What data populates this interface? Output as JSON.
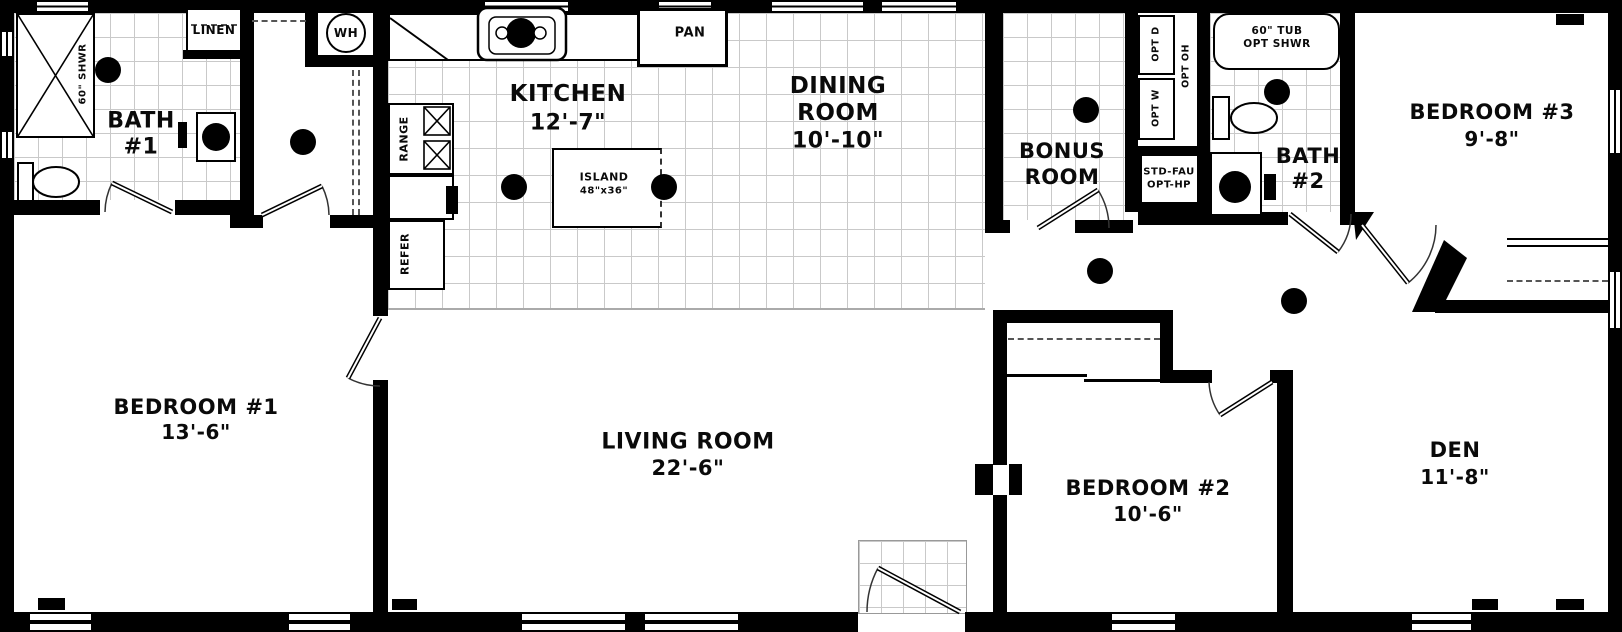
{
  "rooms": {
    "bath1": {
      "l1": "BATH",
      "l2": "#1"
    },
    "kitchen": {
      "l1": "KITCHEN",
      "dim": "12'-7\""
    },
    "dining": {
      "l1": "DINING",
      "l2": "ROOM",
      "dim": "10'-10\""
    },
    "bonus": {
      "l1": "BONUS",
      "l2": "ROOM"
    },
    "bath2": {
      "l1": "BATH",
      "l2": "#2"
    },
    "bedroom3": {
      "l1": "BEDROOM #3",
      "dim": "9'-8\""
    },
    "bedroom1": {
      "l1": "BEDROOM #1",
      "dim": "13'-6\""
    },
    "living": {
      "l1": "LIVING ROOM",
      "dim": "22'-6\""
    },
    "bedroom2": {
      "l1": "BEDROOM #2",
      "dim": "10'-6\""
    },
    "den": {
      "l1": "DEN",
      "dim": "11'-8\""
    }
  },
  "fixtures": {
    "linen": "LINEN",
    "water_heater": "WH",
    "pantry": "PAN",
    "range": "RANGE",
    "refrigerator": "REFER",
    "shower": "60\" SHWR",
    "island_l1": "ISLAND",
    "island_l2": "48\"x36\"",
    "tub_l1": "60\" TUB",
    "tub_l2": "OPT SHWR",
    "opt_dryer": "OPT D",
    "opt_washer": "OPT W",
    "opt_overhead": "OPT OH",
    "furnace_l1": "STD-FAU",
    "furnace_l2": "OPT-HP"
  },
  "colors": {
    "wall": "#000000",
    "grid_line": "#c8c8c8",
    "floor": "#ffffff"
  }
}
